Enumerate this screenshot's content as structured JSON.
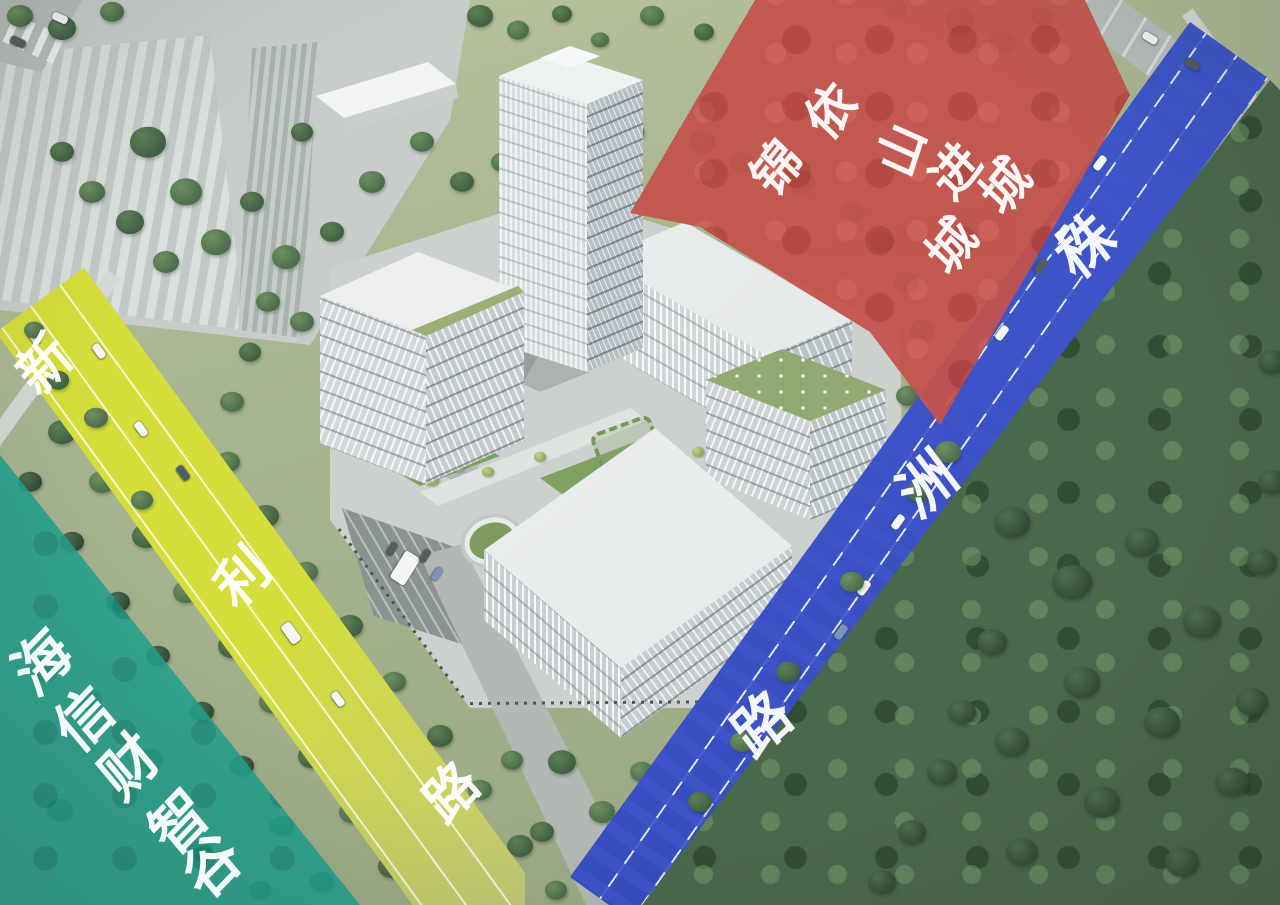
{
  "colors": {
    "red": "#c4524b",
    "teal": "#23a08e",
    "blue_road": "#3c54c8",
    "yellow_road": "#d5de3b"
  },
  "areas": {
    "red_plot": {
      "key": "red-plot",
      "columns": [
        "依山进城",
        "锦城"
      ],
      "font": 50,
      "rot": -52,
      "chars": [
        {
          "c": "依",
          "x": 831,
          "y": 111
        },
        {
          "c": "山",
          "x": 902,
          "y": 150,
          "r": -72
        },
        {
          "c": "进",
          "x": 956,
          "y": 171
        },
        {
          "c": "城",
          "x": 1006,
          "y": 186
        },
        {
          "c": "锦",
          "x": 777,
          "y": 168
        },
        {
          "c": "城",
          "x": 952,
          "y": 246
        }
      ]
    },
    "teal_area": {
      "key": "teal-area",
      "label": "海信财智谷",
      "font": 58,
      "rot": -46,
      "chars": [
        {
          "c": "海",
          "x": 43,
          "y": 663
        },
        {
          "c": "信",
          "x": 85,
          "y": 720
        },
        {
          "c": "财",
          "x": 130,
          "y": 767
        },
        {
          "c": "智",
          "x": 180,
          "y": 823
        },
        {
          "c": "谷",
          "x": 213,
          "y": 867
        }
      ]
    }
  },
  "roads": {
    "blue": {
      "key": "blue-road",
      "name": "株洲路",
      "font": 58,
      "rot": -43,
      "chars": [
        {
          "c": "株",
          "x": 1086,
          "y": 247
        },
        {
          "c": "洲",
          "x": 928,
          "y": 485
        },
        {
          "c": "路",
          "x": 763,
          "y": 725
        }
      ]
    },
    "yellow": {
      "key": "yellow-road",
      "name": "新利路",
      "font": 54,
      "rot": -47,
      "chars": [
        {
          "c": "新",
          "x": 45,
          "y": 365
        },
        {
          "c": "利",
          "x": 243,
          "y": 578
        },
        {
          "c": "路",
          "x": 452,
          "y": 793
        }
      ]
    }
  },
  "vehicles": {
    "cars": [
      [
        1100,
        163,
        126,
        16,
        0
      ],
      [
        1063,
        232,
        126,
        16,
        0
      ],
      [
        1041,
        266,
        126,
        16,
        1
      ],
      [
        1002,
        333,
        126,
        16,
        0
      ],
      [
        898,
        522,
        126,
        16,
        0
      ],
      [
        864,
        588,
        126,
        16,
        0
      ],
      [
        841,
        632,
        126,
        16,
        2
      ],
      [
        762,
        783,
        126,
        22,
        0
      ],
      [
        713,
        852,
        126,
        16,
        0
      ],
      [
        684,
        878,
        126,
        16,
        1
      ],
      [
        34,
        337,
        54,
        16,
        0
      ],
      [
        99,
        351,
        54,
        16,
        0
      ],
      [
        141,
        429,
        54,
        16,
        0
      ],
      [
        183,
        473,
        54,
        16,
        1
      ],
      [
        291,
        633,
        54,
        22,
        0
      ],
      [
        338,
        699,
        54,
        16,
        0
      ],
      [
        1150,
        38,
        31,
        16,
        0
      ],
      [
        1192,
        64,
        31,
        16,
        1
      ],
      [
        60,
        18,
        24,
        16,
        0
      ],
      [
        18,
        42,
        24,
        16,
        1
      ],
      [
        405,
        568,
        122,
        32,
        0
      ],
      [
        425,
        556,
        122,
        14,
        1
      ],
      [
        437,
        574,
        122,
        14,
        2
      ],
      [
        392,
        549,
        122,
        14,
        1
      ]
    ]
  },
  "trees_base": [
    [
      20,
      16,
      13,
      1
    ],
    [
      62,
      28,
      14,
      0
    ],
    [
      112,
      12,
      12,
      1
    ],
    [
      480,
      16,
      13,
      0
    ],
    [
      518,
      30,
      11,
      1
    ],
    [
      562,
      14,
      10,
      0
    ],
    [
      652,
      16,
      12,
      1
    ],
    [
      704,
      32,
      10,
      0
    ],
    [
      600,
      40,
      9,
      1
    ],
    [
      960,
      20,
      15,
      0
    ],
    [
      1002,
      42,
      13,
      1
    ],
    [
      1042,
      16,
      11,
      0
    ],
    [
      896,
      8,
      10,
      1
    ],
    [
      148,
      142,
      18,
      0
    ],
    [
      186,
      192,
      16,
      1
    ],
    [
      130,
      222,
      14,
      0
    ],
    [
      216,
      242,
      15,
      1
    ],
    [
      92,
      192,
      13,
      1
    ],
    [
      252,
      202,
      12,
      0
    ],
    [
      166,
      262,
      13,
      1
    ],
    [
      62,
      152,
      12,
      0
    ],
    [
      286,
      257,
      14,
      1
    ],
    [
      332,
      232,
      12,
      0
    ],
    [
      372,
      182,
      13,
      1
    ],
    [
      302,
      132,
      11,
      0
    ],
    [
      422,
      142,
      12,
      1
    ],
    [
      352,
      302,
      14,
      0
    ],
    [
      302,
      322,
      12,
      1
    ],
    [
      338,
      352,
      12,
      0
    ],
    [
      368,
      330,
      11,
      1
    ],
    [
      462,
      182,
      12,
      0
    ],
    [
      502,
      162,
      11,
      1
    ],
    [
      592,
      152,
      12,
      0
    ],
    [
      632,
      132,
      12,
      1
    ],
    [
      702,
      142,
      13,
      0
    ],
    [
      742,
      162,
      12,
      1
    ],
    [
      802,
      182,
      13,
      0
    ],
    [
      852,
      212,
      12,
      1
    ],
    [
      882,
      242,
      12,
      0
    ],
    [
      906,
      282,
      12,
      1
    ],
    [
      922,
      330,
      12,
      0
    ],
    [
      268,
      302,
      12,
      1
    ],
    [
      250,
      352,
      11,
      0
    ],
    [
      232,
      402,
      12,
      1
    ],
    [
      30,
      482,
      12,
      3
    ],
    [
      62,
      432,
      14,
      0
    ],
    [
      72,
      542,
      12,
      3
    ],
    [
      102,
      482,
      13,
      1
    ],
    [
      118,
      602,
      12,
      3
    ],
    [
      146,
      536,
      14,
      0
    ],
    [
      158,
      656,
      12,
      3
    ],
    [
      186,
      592,
      13,
      1
    ],
    [
      202,
      712,
      12,
      3
    ],
    [
      232,
      646,
      14,
      0
    ],
    [
      242,
      766,
      12,
      3
    ],
    [
      272,
      702,
      13,
      1
    ],
    [
      282,
      826,
      12,
      3
    ],
    [
      312,
      756,
      14,
      0
    ],
    [
      322,
      882,
      12,
      3
    ],
    [
      352,
      812,
      13,
      1
    ],
    [
      392,
      866,
      14,
      0
    ],
    [
      150,
      760,
      13,
      3
    ],
    [
      90,
      700,
      12,
      3
    ],
    [
      60,
      810,
      13,
      3
    ],
    [
      200,
      850,
      12,
      3
    ],
    [
      260,
      890,
      11,
      3
    ],
    [
      228,
      462,
      12,
      1
    ],
    [
      266,
      516,
      13,
      0
    ],
    [
      306,
      572,
      12,
      1
    ],
    [
      350,
      626,
      13,
      0
    ],
    [
      394,
      682,
      12,
      1
    ],
    [
      440,
      736,
      13,
      0
    ],
    [
      480,
      790,
      12,
      1
    ],
    [
      520,
      846,
      13,
      0
    ],
    [
      556,
      890,
      11,
      1
    ],
    [
      562,
      762,
      14,
      0
    ],
    [
      602,
      812,
      13,
      1
    ],
    [
      542,
      832,
      12,
      0
    ],
    [
      642,
      772,
      12,
      1
    ],
    [
      682,
      832,
      13,
      0
    ],
    [
      592,
      872,
      11,
      1
    ],
    [
      702,
      882,
      12,
      0
    ],
    [
      632,
      902,
      11,
      1
    ],
    [
      512,
      760,
      11,
      1
    ],
    [
      908,
      396,
      12,
      1
    ],
    [
      932,
      442,
      13,
      0
    ],
    [
      896,
      472,
      11,
      1
    ],
    [
      862,
      522,
      12,
      0
    ],
    [
      882,
      562,
      11,
      1
    ],
    [
      842,
      602,
      13,
      0
    ],
    [
      816,
      652,
      12,
      1
    ],
    [
      792,
      702,
      11,
      0
    ],
    [
      756,
      752,
      12,
      1
    ],
    [
      736,
      802,
      11,
      0
    ],
    [
      1152,
      222,
      15,
      3
    ],
    [
      1202,
      262,
      14,
      3
    ],
    [
      1252,
      302,
      13,
      3
    ],
    [
      1182,
      332,
      12,
      3
    ],
    [
      1232,
      382,
      13,
      3
    ],
    [
      1262,
      442,
      12,
      3
    ],
    [
      1122,
      182,
      12,
      3
    ],
    [
      1142,
      136,
      11,
      1
    ],
    [
      1216,
      186,
      12,
      3
    ],
    [
      432,
      480,
      7,
      2
    ],
    [
      458,
      467,
      6,
      2
    ],
    [
      488,
      472,
      6,
      2
    ],
    [
      540,
      457,
      6,
      2
    ],
    [
      566,
      607,
      7,
      2
    ],
    [
      598,
      638,
      6,
      2
    ],
    [
      652,
      620,
      6,
      2
    ],
    [
      676,
      470,
      6,
      2
    ],
    [
      698,
      452,
      6,
      2
    ],
    [
      608,
      585,
      6,
      2
    ],
    [
      522,
      600,
      6,
      2
    ],
    [
      560,
      512,
      5,
      2
    ],
    [
      414,
      452,
      6,
      2
    ],
    [
      442,
      440,
      5,
      2
    ]
  ],
  "trees_top": [
    [
      1012,
      522,
      18,
      3
    ],
    [
      1072,
      582,
      20,
      3
    ],
    [
      1142,
      542,
      17,
      3
    ],
    [
      1202,
      622,
      19,
      3
    ],
    [
      1082,
      682,
      18,
      3
    ],
    [
      1012,
      742,
      17,
      3
    ],
    [
      1162,
      722,
      18,
      3
    ],
    [
      1232,
      782,
      17,
      3
    ],
    [
      1102,
      802,
      18,
      3
    ],
    [
      1022,
      852,
      16,
      3
    ],
    [
      1182,
      862,
      17,
      3
    ],
    [
      1252,
      702,
      16,
      3
    ],
    [
      1262,
      562,
      15,
      3
    ],
    [
      992,
      642,
      15,
      3
    ],
    [
      962,
      712,
      14,
      3
    ],
    [
      942,
      772,
      15,
      3
    ],
    [
      912,
      832,
      14,
      3
    ],
    [
      882,
      882,
      14,
      3
    ],
    [
      1272,
      362,
      14,
      3
    ],
    [
      1272,
      482,
      14,
      3
    ],
    [
      948,
      452,
      13,
      1
    ],
    [
      918,
      492,
      12,
      0
    ],
    [
      852,
      582,
      12,
      1
    ],
    [
      788,
      672,
      12,
      0
    ],
    [
      742,
      742,
      12,
      1
    ],
    [
      700,
      802,
      12,
      0
    ],
    [
      96,
      418,
      12,
      1
    ],
    [
      58,
      380,
      11,
      0
    ],
    [
      142,
      500,
      11,
      1
    ],
    [
      34,
      330,
      10,
      1
    ]
  ]
}
